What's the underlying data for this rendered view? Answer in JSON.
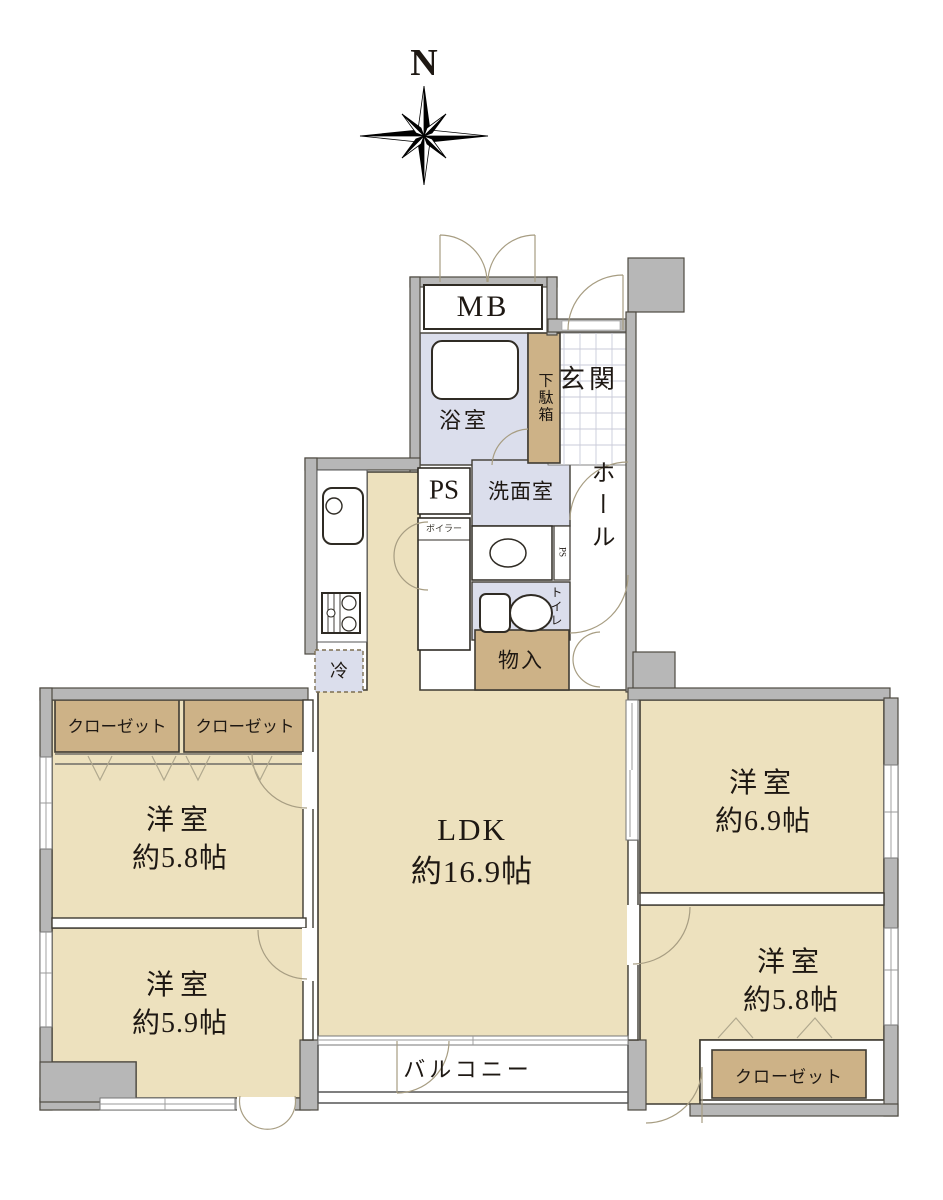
{
  "compass": {
    "label": "N"
  },
  "colors": {
    "room_fill": "#EDE1BE",
    "closet_fill": "#CDB287",
    "wet_area_fill": "#DBDEEC",
    "wall_fill": "#B7B7B7",
    "outline": "#3F3B32"
  },
  "labels": {
    "mb": "MB",
    "genkan": "玄関",
    "getabako": "下駄箱",
    "bathroom": "浴室",
    "ps": "PS",
    "boiler": "ボイラー",
    "washroom": "洗面室",
    "ps_small": "PS",
    "toilet": "トイレ",
    "hall": "ホール",
    "storage": "物入",
    "fridge": "冷",
    "closet_nw_left": "クローゼット",
    "closet_nw_right": "クローゼット",
    "closet_se": "クローゼット",
    "balcony": "バルコニー"
  },
  "rooms": {
    "nw": {
      "name": "洋室",
      "area": "約5.8帖"
    },
    "sw": {
      "name": "洋室",
      "area": "約5.9帖"
    },
    "ldk": {
      "name": "LDK",
      "area": "約16.9帖"
    },
    "ne": {
      "name": "洋室",
      "area": "約6.9帖"
    },
    "se": {
      "name": "洋室",
      "area": "約5.8帖"
    }
  }
}
